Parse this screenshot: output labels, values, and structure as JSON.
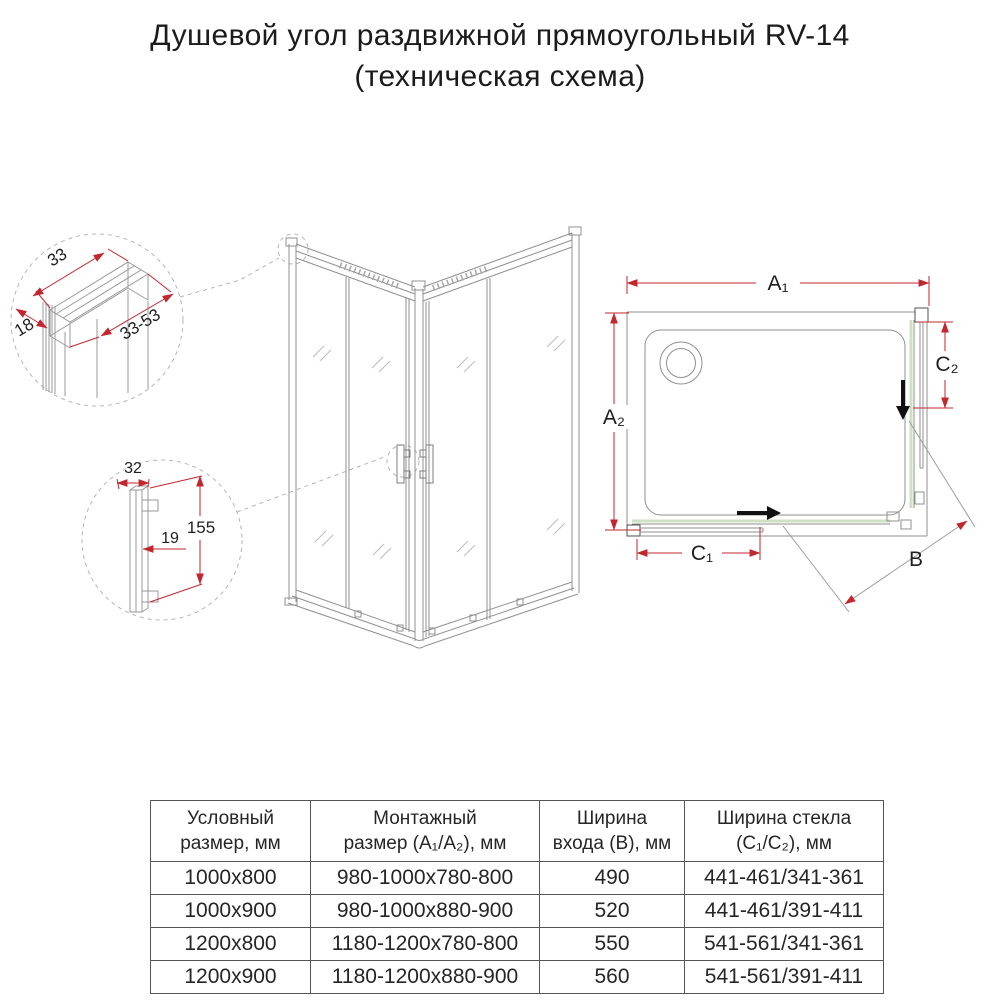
{
  "title": {
    "line1": "Душевой угол раздвижной прямоугольный RV-14",
    "line2": "(техническая схема)"
  },
  "colors": {
    "dimension_red": "#c2272e",
    "glass_green": "#cfe0c3",
    "line_gray": "#8f8f8f",
    "arrow_black": "#111111"
  },
  "details": {
    "profile": {
      "width": "33",
      "depth": "18",
      "range": "33-53"
    },
    "handle": {
      "depth": "32",
      "gap": "19",
      "height": "155"
    }
  },
  "plan_labels": {
    "a1": "A₁",
    "a2": "A₂",
    "b": "B",
    "c1": "C₁",
    "c2": "C₂"
  },
  "table": {
    "headers": [
      {
        "line1": "Условный",
        "line2": "размер, мм"
      },
      {
        "line1": "Монтажный",
        "line2": "размер (A₁/A₂), мм"
      },
      {
        "line1": "Ширина",
        "line2": "входа (B), мм"
      },
      {
        "line1": "Ширина стекла",
        "line2": "(C₁/C₂), мм"
      }
    ],
    "rows": [
      [
        "1000x800",
        "980-1000x780-800",
        "490",
        "441-461/341-361"
      ],
      [
        "1000x900",
        "980-1000x880-900",
        "520",
        "441-461/391-411"
      ],
      [
        "1200x800",
        "1180-1200x780-800",
        "550",
        "541-561/341-361"
      ],
      [
        "1200x900",
        "1180-1200x880-900",
        "560",
        "541-561/391-411"
      ]
    ]
  }
}
